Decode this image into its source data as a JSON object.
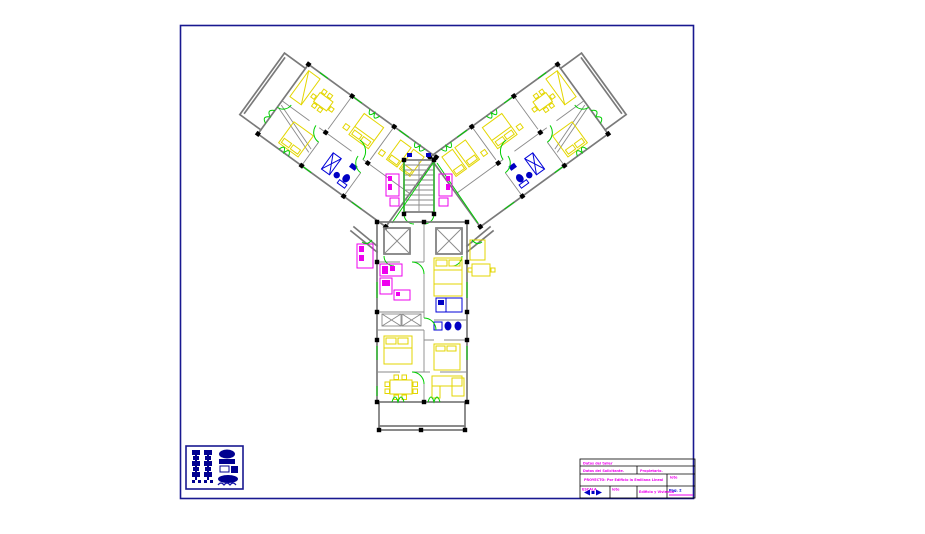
{
  "sheet": {
    "background": "#ffffff",
    "border_color": "#181890",
    "description_colors": {
      "walls": "#7a7a7a",
      "doors_windows": "#00cf00",
      "furniture": "#e3d600",
      "kitchen_bath_fixtures": "#ee00ee",
      "plumbing_furniture": "#0000c4",
      "columns": "#000000"
    }
  },
  "title_block": {
    "row1": "Datos del taller",
    "row2a": "Datos del Solicitante.",
    "row2b": "Propietario.",
    "row3a": "PROYECTO: Por Edificio la Emiliana Lineal",
    "row3b": "lote",
    "row4a": "ESCALA",
    "row4b": "lote",
    "row4c": "Edificio y Vivienda",
    "row4d": "Pag. 2",
    "scale_symbol": "◄◆►"
  }
}
